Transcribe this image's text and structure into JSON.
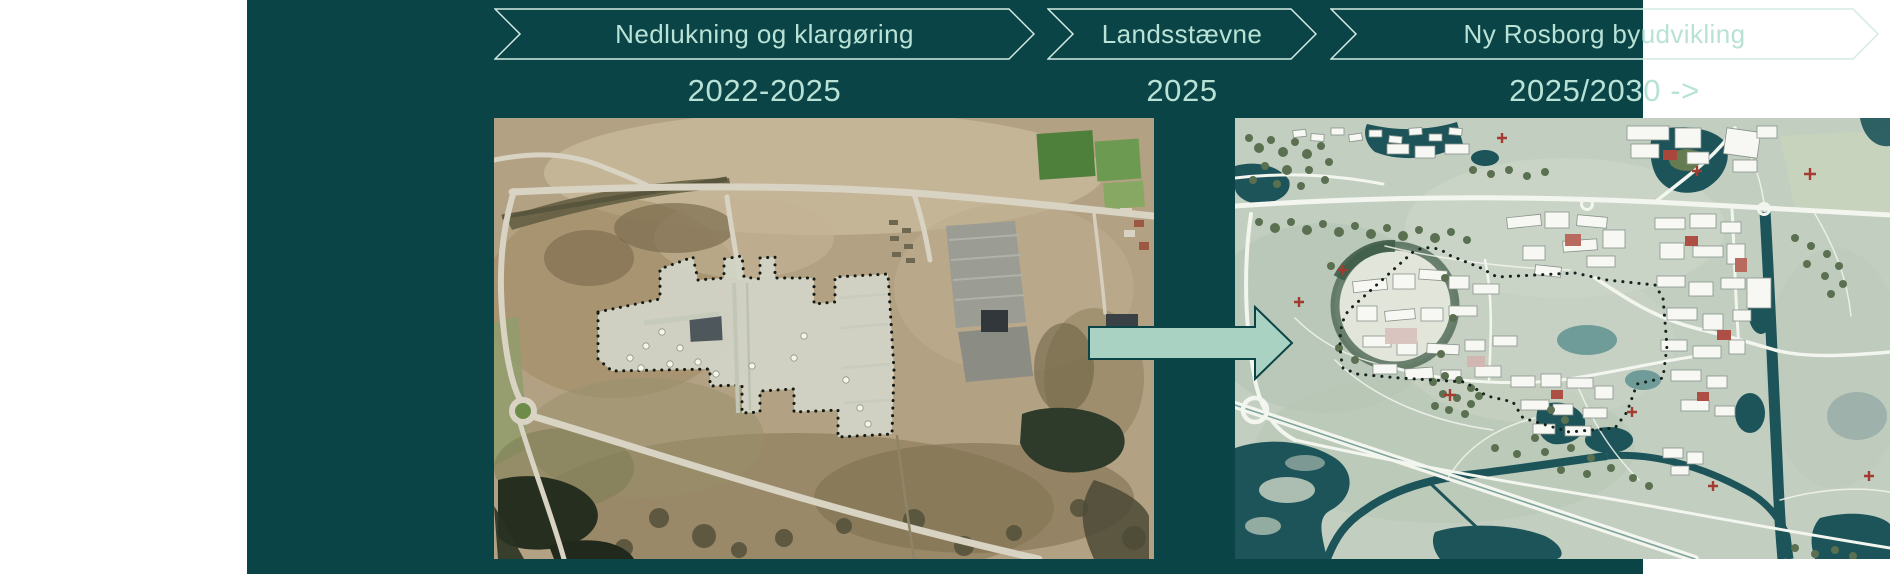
{
  "phases": [
    {
      "label": "Nedlukning og klargøring",
      "period": "2022-2025"
    },
    {
      "label": "Landsstævne",
      "period": "2025"
    },
    {
      "label": "Ny Rosborg byudvikling",
      "period": "2025/2030 ->"
    }
  ],
  "figures": {
    "left": "satellite-aerial-photo-of-site",
    "right": "urban-development-plan-map"
  },
  "icons": {
    "transition_arrow": "right-arrow"
  },
  "colors": {
    "background": "#ffffff",
    "panel": "#0a4446",
    "text": "#b9e2d6",
    "chevron_outline": "#d4ebe4",
    "arrow_fill": "#a9d2c2"
  }
}
